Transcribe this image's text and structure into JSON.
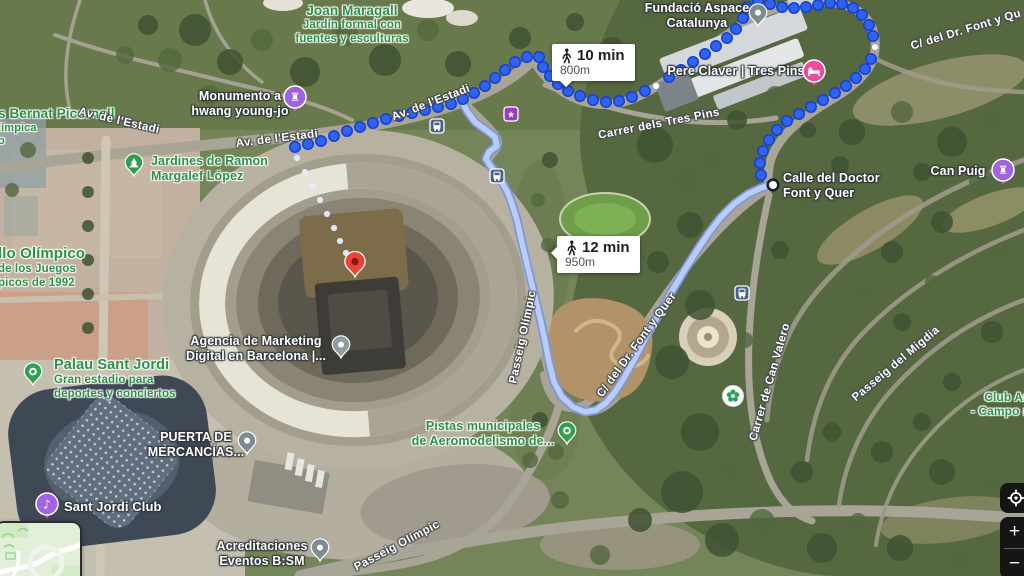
{
  "app": {
    "name": "Google Maps satellite walking navigation"
  },
  "routes": {
    "walk_1": {
      "badge": {
        "duration": "10 min",
        "distance": "800m"
      },
      "dot_color": "#2e64f1",
      "dot_border": "#1b3fd1",
      "dots": [
        [
          295,
          147
        ],
        [
          308,
          144
        ],
        [
          321,
          141
        ],
        [
          334,
          136
        ],
        [
          347,
          131
        ],
        [
          360,
          127
        ],
        [
          373,
          123
        ],
        [
          386,
          119
        ],
        [
          399,
          116
        ],
        [
          412,
          113
        ],
        [
          425,
          110
        ],
        [
          438,
          107
        ],
        [
          451,
          104
        ],
        [
          463,
          99
        ],
        [
          474,
          93
        ],
        [
          485,
          86
        ],
        [
          495,
          78
        ],
        [
          505,
          70
        ],
        [
          515,
          62
        ],
        [
          527,
          57
        ],
        [
          539,
          57
        ],
        [
          543,
          67
        ],
        [
          550,
          76
        ],
        [
          558,
          84
        ],
        [
          568,
          91
        ],
        [
          580,
          96
        ],
        [
          593,
          100
        ],
        [
          606,
          102
        ],
        [
          619,
          101
        ],
        [
          632,
          97
        ],
        [
          645,
          91
        ],
        [
          669,
          77
        ],
        [
          681,
          70
        ],
        [
          693,
          62
        ],
        [
          705,
          54
        ],
        [
          716,
          46
        ],
        [
          727,
          38
        ],
        [
          736,
          29
        ],
        [
          743,
          18
        ],
        [
          747,
          7
        ],
        [
          758,
          1
        ],
        [
          770,
          4
        ],
        [
          782,
          7
        ],
        [
          794,
          8
        ],
        [
          806,
          7
        ],
        [
          818,
          5
        ],
        [
          830,
          3
        ],
        [
          842,
          4
        ],
        [
          853,
          8
        ],
        [
          862,
          15
        ],
        [
          869,
          25
        ],
        [
          873,
          36
        ],
        [
          871,
          59
        ],
        [
          865,
          69
        ],
        [
          856,
          78
        ],
        [
          846,
          86
        ],
        [
          835,
          93
        ],
        [
          823,
          100
        ],
        [
          811,
          107
        ],
        [
          799,
          114
        ],
        [
          787,
          121
        ],
        [
          777,
          130
        ],
        [
          769,
          140
        ],
        [
          763,
          151
        ],
        [
          760,
          163
        ],
        [
          761,
          175
        ]
      ]
    },
    "walk_2": {
      "badge": {
        "duration": "12 min",
        "distance": "950m"
      },
      "fill_color": "#b9cdfa",
      "border_color": "#8096d8",
      "path": [
        [
          461,
          99
        ],
        [
          467,
          111
        ],
        [
          475,
          122
        ],
        [
          486,
          130
        ],
        [
          495,
          137
        ],
        [
          497,
          146
        ],
        [
          489,
          152
        ],
        [
          486,
          159
        ],
        [
          492,
          168
        ],
        [
          500,
          179
        ],
        [
          507,
          191
        ],
        [
          512,
          204
        ],
        [
          517,
          220
        ],
        [
          522,
          243
        ],
        [
          528,
          268
        ],
        [
          534,
          293
        ],
        [
          540,
          318
        ],
        [
          545,
          341
        ],
        [
          549,
          362
        ],
        [
          554,
          382
        ],
        [
          562,
          397
        ],
        [
          573,
          407
        ],
        [
          585,
          412
        ],
        [
          596,
          410
        ],
        [
          606,
          403
        ],
        [
          615,
          392
        ],
        [
          624,
          378
        ],
        [
          635,
          358
        ],
        [
          647,
          335
        ],
        [
          660,
          312
        ],
        [
          672,
          291
        ],
        [
          684,
          271
        ],
        [
          696,
          252
        ],
        [
          708,
          234
        ],
        [
          721,
          217
        ],
        [
          734,
          204
        ],
        [
          748,
          194
        ],
        [
          761,
          188
        ],
        [
          772,
          184
        ]
      ]
    },
    "destination_trail": {
      "color": "#e6ecfd",
      "dots": [
        [
          297,
          158
        ],
        [
          305,
          172
        ],
        [
          313,
          186
        ],
        [
          320,
          200
        ],
        [
          327,
          214
        ],
        [
          334,
          228
        ],
        [
          340,
          241
        ],
        [
          346,
          253
        ]
      ]
    },
    "waypoints": {
      "small": [
        [
          656,
          86
        ],
        [
          875,
          47
        ]
      ],
      "terminus": [
        773,
        185
      ]
    }
  },
  "labels": {
    "poi": [
      {
        "id": "joan-maragall",
        "x": 352,
        "y": 3,
        "align": "center",
        "color": "green",
        "title_lines": 1,
        "title_size": 13.5,
        "sub_size": 11.5,
        "lines": [
          "Joan Maragall",
          "Jardín formal con",
          "fuentes y esculturas"
        ]
      },
      {
        "id": "fundacio-aspace",
        "x": 697,
        "y": 1,
        "align": "center",
        "color": "white",
        "title_lines": 2,
        "title_size": 12.5,
        "sub_size": 12.5,
        "lines": [
          "Fundació Aspace",
          "Catalunya"
        ]
      },
      {
        "id": "pere-claver",
        "x": 736,
        "y": 64,
        "align": "center",
        "color": "white",
        "title_lines": 1,
        "title_size": 12.5,
        "sub_size": 12.5,
        "lines": [
          "Pere Claver | Tres Pins"
        ]
      },
      {
        "id": "monumento-hwang",
        "x": 240,
        "y": 89,
        "align": "center",
        "color": "white",
        "title_lines": 2,
        "title_size": 12.5,
        "sub_size": 12.5,
        "lines": [
          "Monumento a",
          "hwang young-jo"
        ]
      },
      {
        "id": "bernat-picornell",
        "x": -2,
        "y": 106,
        "align": "left",
        "color": "green",
        "title_lines": 1,
        "title_size": 13.5,
        "sub_size": 11,
        "lines": [
          "s Bernat Picornell",
          "límpica",
          "o"
        ]
      },
      {
        "id": "jardines-ramon",
        "x": 151,
        "y": 154,
        "align": "left",
        "color": "green",
        "title_lines": 2,
        "title_size": 12.5,
        "sub_size": 12.5,
        "lines": [
          "Jardines de Ramon",
          "Margalef López"
        ]
      },
      {
        "id": "anillo-olimpico",
        "x": -2,
        "y": 245,
        "align": "left",
        "color": "green",
        "title_lines": 1,
        "title_size": 15,
        "sub_size": 11.5,
        "lines": [
          "llo Olímpico",
          "de los Juegos",
          "picos de 1992"
        ]
      },
      {
        "id": "palau-sant-jordi",
        "x": 54,
        "y": 357,
        "align": "left",
        "color": "green",
        "title_lines": 1,
        "title_size": 14.5,
        "sub_size": 11.5,
        "lines": [
          "Palau Sant Jordi",
          "Gran estadio para",
          "deportes y conciertos"
        ]
      },
      {
        "id": "agencia-marketing",
        "x": 256,
        "y": 334,
        "align": "center",
        "color": "white",
        "title_lines": 2,
        "title_size": 12.5,
        "sub_size": 12.5,
        "lines": [
          "Agencia de Marketing",
          "Digital en Barcelona |..."
        ]
      },
      {
        "id": "puerta-mercancias",
        "x": 196,
        "y": 430,
        "align": "center",
        "color": "white",
        "title_lines": 2,
        "title_size": 12.5,
        "sub_size": 12.5,
        "lines": [
          "PUERTA DE",
          "MERCANCÍAS..."
        ]
      },
      {
        "id": "pistas-aeromodelismo",
        "x": 483,
        "y": 419,
        "align": "center",
        "color": "green",
        "title_lines": 2,
        "title_size": 12.5,
        "sub_size": 12.5,
        "lines": [
          "Pistas municipales",
          "de Aeromodelismo de..."
        ]
      },
      {
        "id": "sant-jordi-club",
        "x": 64,
        "y": 499,
        "align": "left",
        "color": "white",
        "title_lines": 1,
        "title_size": 13,
        "sub_size": 13,
        "lines": [
          "Sant Jordi Club"
        ]
      },
      {
        "id": "acreditaciones",
        "x": 262,
        "y": 539,
        "align": "center",
        "color": "white",
        "title_lines": 2,
        "title_size": 12.5,
        "sub_size": 12.5,
        "lines": [
          "Acreditaciones",
          "Eventos B:SM"
        ]
      },
      {
        "id": "can-puig",
        "x": 958,
        "y": 164,
        "align": "center",
        "color": "white",
        "title_lines": 1,
        "title_size": 12.5,
        "sub_size": 12.5,
        "lines": [
          "Can Puig"
        ]
      },
      {
        "id": "club-campo",
        "x": 1006,
        "y": 390,
        "align": "center",
        "color": "green",
        "title_lines": 2,
        "title_size": 12,
        "sub_size": 12,
        "lines": [
          "Club Ar",
          "- Campo mu"
        ]
      },
      {
        "id": "calle-doctor-font",
        "x": 783,
        "y": 171,
        "align": "left",
        "color": "white",
        "title_lines": 2,
        "title_size": 12.5,
        "sub_size": 12.5,
        "lines": [
          "Calle del Doctor",
          "Font y Quer"
        ]
      }
    ],
    "roads": [
      {
        "text": "Av. de l'Estadi",
        "x": 119,
        "y": 121,
        "angle": 13
      },
      {
        "text": "Av. de l'Estadi",
        "x": 277,
        "y": 139,
        "angle": -7
      },
      {
        "text": "Av. de l'Estadi",
        "x": 431,
        "y": 103,
        "angle": -21
      },
      {
        "text": "Carrer dels Tres Pins",
        "x": 659,
        "y": 124,
        "angle": -11
      },
      {
        "text": "C/ del Dr. Font y Qu",
        "x": 966,
        "y": 30,
        "angle": -17
      },
      {
        "text": "Passeig Olímpic",
        "x": 523,
        "y": 337,
        "angle": -78
      },
      {
        "text": "C/ del Dr. Font y Quer",
        "x": 637,
        "y": 345,
        "angle": -54
      },
      {
        "text": "Carrer de Can Valero",
        "x": 770,
        "y": 382,
        "angle": -74
      },
      {
        "text": "Passeig del Migdia",
        "x": 896,
        "y": 364,
        "angle": -40
      },
      {
        "text": "Passeig Olímpic",
        "x": 397,
        "y": 546,
        "angle": -28
      }
    ]
  },
  "icons": [
    {
      "kind": "pin",
      "name": "fundacio-aspace-pin",
      "x": 758,
      "y": 26,
      "color": "#7d8c94",
      "glyph": "dot"
    },
    {
      "kind": "circle",
      "name": "pere-claver-lodging-icon",
      "x": 814,
      "y": 71,
      "color": "#ec4d9b",
      "glyph": "bed"
    },
    {
      "kind": "circle",
      "name": "monumento-hwang-icon",
      "x": 295,
      "y": 97,
      "color": "#a163e0",
      "glyph": "rook"
    },
    {
      "kind": "pin",
      "name": "jardines-ramon-pin",
      "x": 134,
      "y": 176,
      "color": "#2f9e4e",
      "glyph": "tree"
    },
    {
      "kind": "pin",
      "name": "palau-sant-jordi-pin",
      "x": 33,
      "y": 385,
      "color": "#31a052",
      "glyph": "ring"
    },
    {
      "kind": "pin",
      "name": "agencia-marketing-pin",
      "x": 341,
      "y": 358,
      "color": "#8e9ba1",
      "glyph": "dot"
    },
    {
      "kind": "pin",
      "name": "puerta-mercancias-pin",
      "x": 247,
      "y": 454,
      "color": "#7d8c94",
      "glyph": "dot"
    },
    {
      "kind": "pin",
      "name": "pistas-aeromodelismo-pin",
      "x": 567,
      "y": 444,
      "color": "#31a052",
      "glyph": "ring"
    },
    {
      "kind": "circle",
      "name": "sant-jordi-club-music-icon",
      "x": 47,
      "y": 504,
      "color": "#a163e0",
      "glyph": "music"
    },
    {
      "kind": "pin",
      "name": "acreditaciones-pin",
      "x": 320,
      "y": 561,
      "color": "#7d8c94",
      "glyph": "dot"
    },
    {
      "kind": "circle",
      "name": "can-puig-icon",
      "x": 1003,
      "y": 170,
      "color": "#a163e0",
      "glyph": "rook"
    },
    {
      "kind": "square",
      "name": "bus-stop-icon",
      "x": 437,
      "y": 126,
      "color": "#4a6285",
      "glyph": "bus"
    },
    {
      "kind": "square",
      "name": "bus-stop-icon",
      "x": 497,
      "y": 176,
      "color": "#4a6285",
      "glyph": "bus"
    },
    {
      "kind": "square",
      "name": "bus-stop-icon",
      "x": 742,
      "y": 293,
      "color": "#4a6285",
      "glyph": "bus"
    },
    {
      "kind": "square",
      "name": "attraction-icon",
      "x": 511,
      "y": 114,
      "color": "#9d3bbf",
      "glyph": "star"
    },
    {
      "kind": "park",
      "name": "park-flower-icon",
      "x": 733,
      "y": 396,
      "color": "#2aa25c",
      "glyph": "flower"
    },
    {
      "kind": "red-pin",
      "name": "destination-pin",
      "x": 355,
      "y": 277,
      "color": "#ea4335",
      "glyph": "dot-dark"
    }
  ],
  "controls": {
    "zoom_in": "+",
    "zoom_out": "−"
  }
}
